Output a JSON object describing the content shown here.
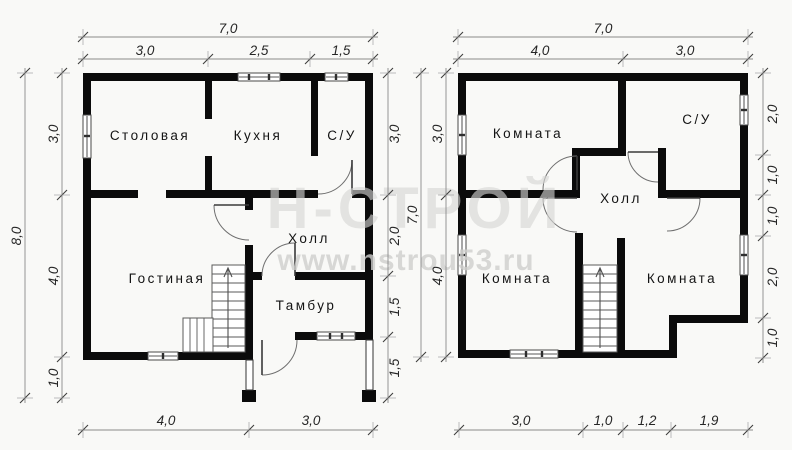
{
  "watermark": {
    "brand": "Н-СТРОЙ",
    "url": "www.nstrou53.ru"
  },
  "floor1": {
    "rooms": {
      "dining": "Столовая",
      "kitchen": "Кухня",
      "bathroom": "С/У",
      "living": "Гостиная",
      "hall": "Холл",
      "vestibule": "Тамбур"
    },
    "dims": {
      "top_total": "7,0",
      "top": [
        "3,0",
        "2,5",
        "1,5"
      ],
      "left_total": "8,0",
      "left": [
        "3,0",
        "4,0",
        "1,0"
      ],
      "right": [
        "3,0",
        "2,0",
        "1,5",
        "1,5"
      ],
      "bottom": [
        "4,0",
        "3,0"
      ]
    }
  },
  "floor2": {
    "rooms": {
      "room_top": "Комната",
      "bathroom": "С/У",
      "hall": "Холл",
      "room_bottom_left": "Комната",
      "room_bottom_right": "Комната"
    },
    "dims": {
      "top_total": "7,0",
      "top": [
        "4,0",
        "3,0"
      ],
      "left_total": "7,0",
      "left": [
        "3,0",
        "4,0"
      ],
      "right": [
        "2,0",
        "1,0",
        "1,0",
        "2,0",
        "1,0"
      ],
      "bottom": [
        "3,0",
        "1,0",
        "1,2",
        "1,9"
      ]
    }
  }
}
